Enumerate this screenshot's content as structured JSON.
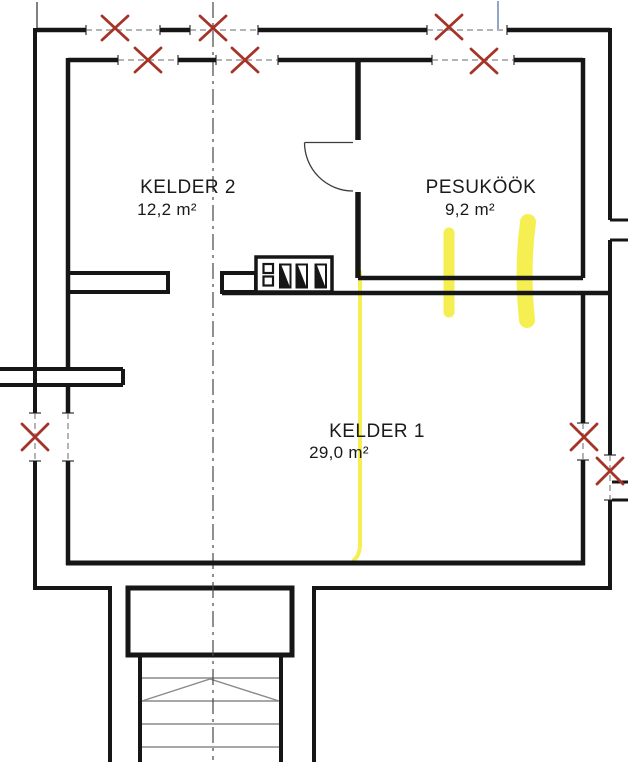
{
  "plan": {
    "rooms": [
      {
        "name": "KELDER 2",
        "area": "12,2 m²"
      },
      {
        "name": "PESUKÖÖK",
        "area": "9,2 m²"
      },
      {
        "name": "KELDER 1",
        "area": "29,0 m²"
      }
    ]
  },
  "colors": {
    "wall": "#161616",
    "text": "#1A1A1A",
    "demolition": "#A53327",
    "highlight": "#F5ED3E",
    "centerline": "#454545",
    "reference": "#8FA6C4",
    "stair": "#8A8A8A",
    "window_dash": "#9B9B9B",
    "tick": "#5A5A5A",
    "thin": "#3C3C3C"
  }
}
